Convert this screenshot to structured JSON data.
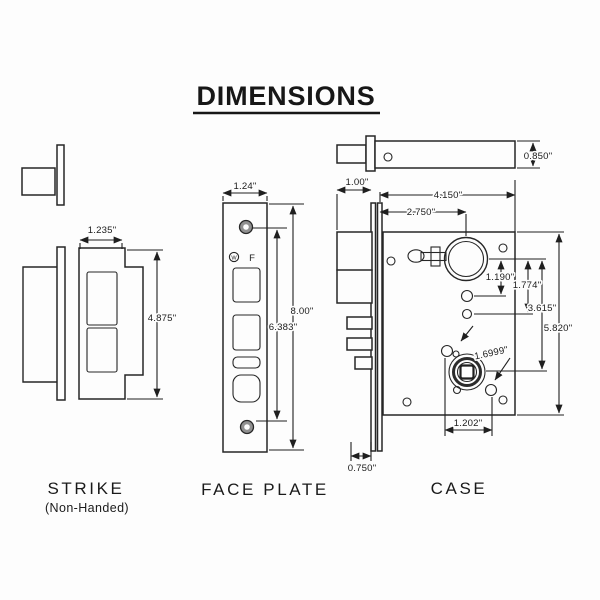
{
  "title": "DIMENSIONS",
  "views": {
    "strike": {
      "label": "STRIKE",
      "sublabel": "(Non-Handed)",
      "dims": {
        "width": "1.235\"",
        "height": "4.875\""
      }
    },
    "face_plate": {
      "label": "FACE PLATE",
      "marking_circle": "W",
      "marking_f": "F",
      "dims": {
        "width": "1.24\"",
        "height_outer": "8.00\"",
        "height_inner": "6.383\""
      }
    },
    "case": {
      "label": "CASE",
      "dims": {
        "top_thickness": "0.850\"",
        "bolt_projection": "1.00\"",
        "body_length": "4.150\"",
        "backset": "2.750\"",
        "cyl_to_hole1": "1.190\"",
        "cyl_to_hole2": "1.774\"",
        "cyl_to_hub": "3.615\"",
        "case_height": "5.820\"",
        "hub_diagonal": "1.6999\"",
        "hub_hole_span": "1.202\"",
        "faceplate_edge": "0.750\""
      }
    }
  }
}
